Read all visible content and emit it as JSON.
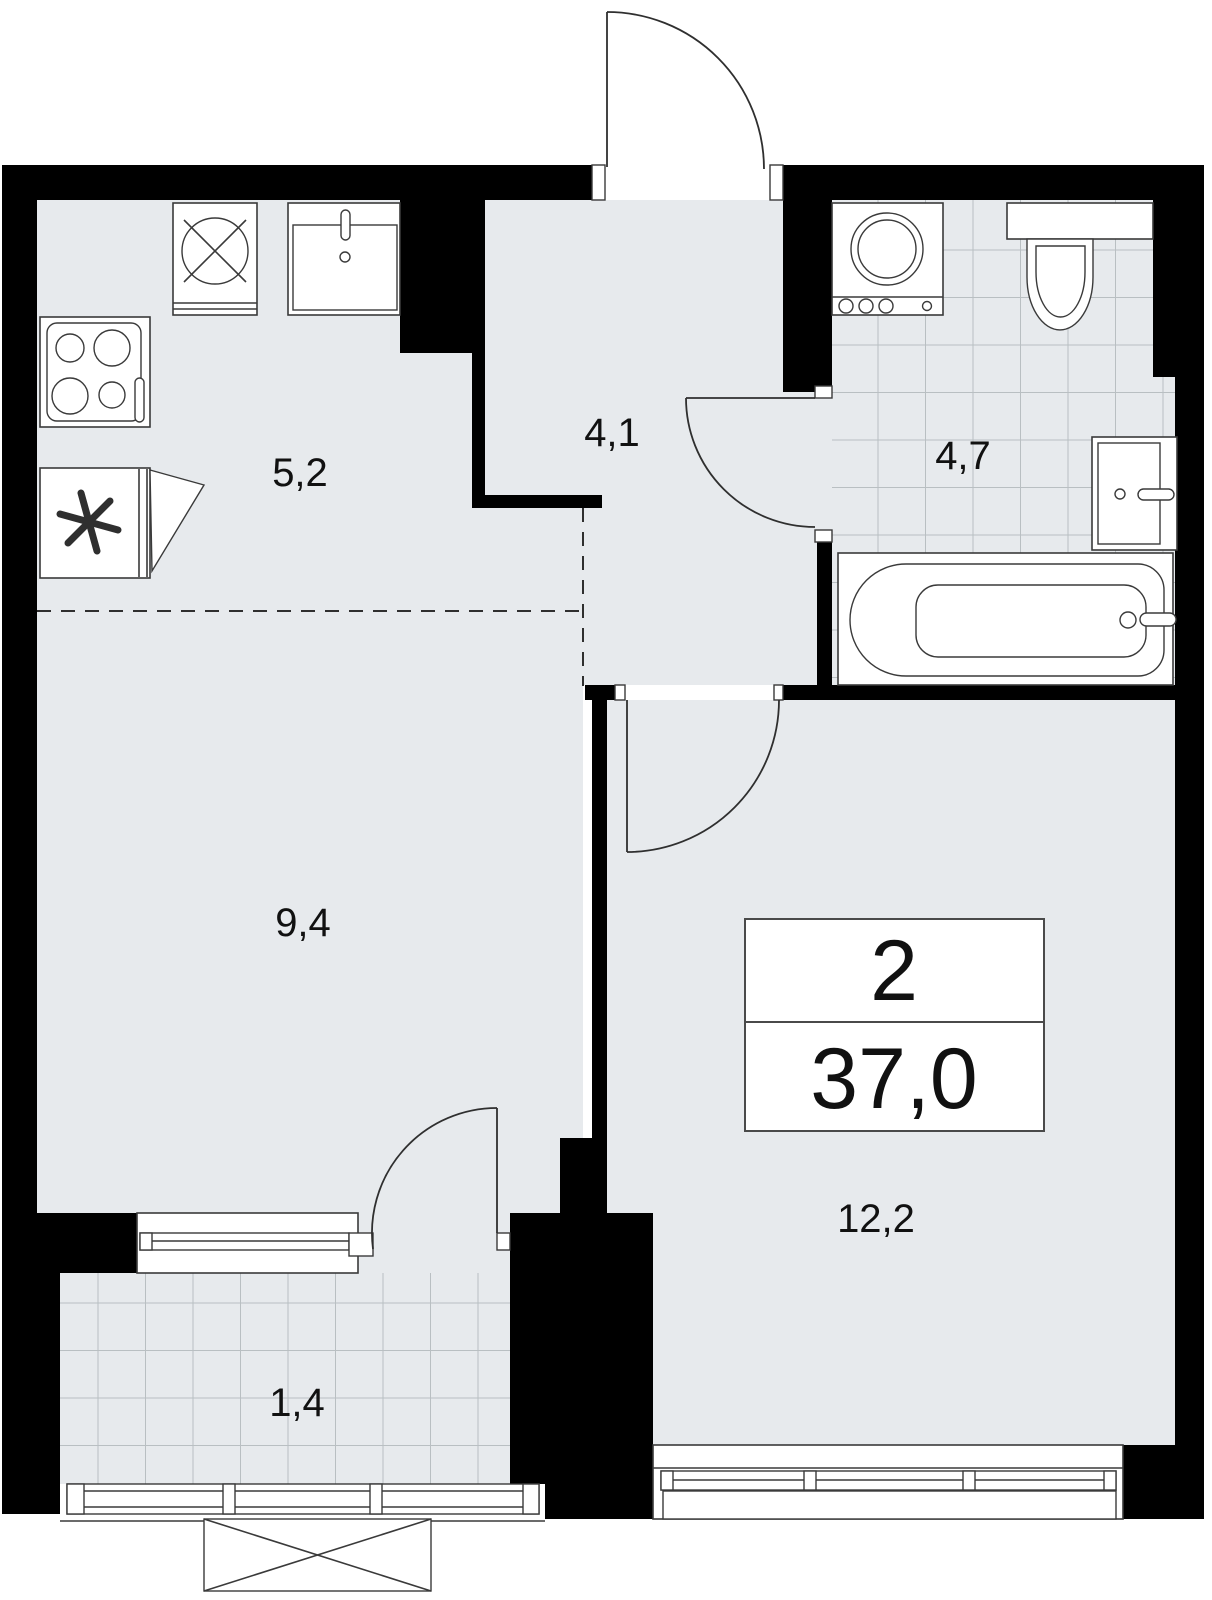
{
  "plan": {
    "info_box": {
      "rooms_count": "2",
      "total_area": "37,0"
    },
    "rooms": [
      {
        "id": "kitchen",
        "area_label": "5,2"
      },
      {
        "id": "hallway",
        "area_label": "4,1"
      },
      {
        "id": "bathroom",
        "area_label": "4,7"
      },
      {
        "id": "living-room",
        "area_label": "9,4"
      },
      {
        "id": "bedroom",
        "area_label": "12,2"
      },
      {
        "id": "balcony",
        "area_label": "1,4"
      }
    ],
    "colors": {
      "wall": "#000000",
      "floor": "#e7eaed",
      "tile_line": "#b9bfc2",
      "outline": "#3a3a3a",
      "background": "#ffffff"
    }
  }
}
